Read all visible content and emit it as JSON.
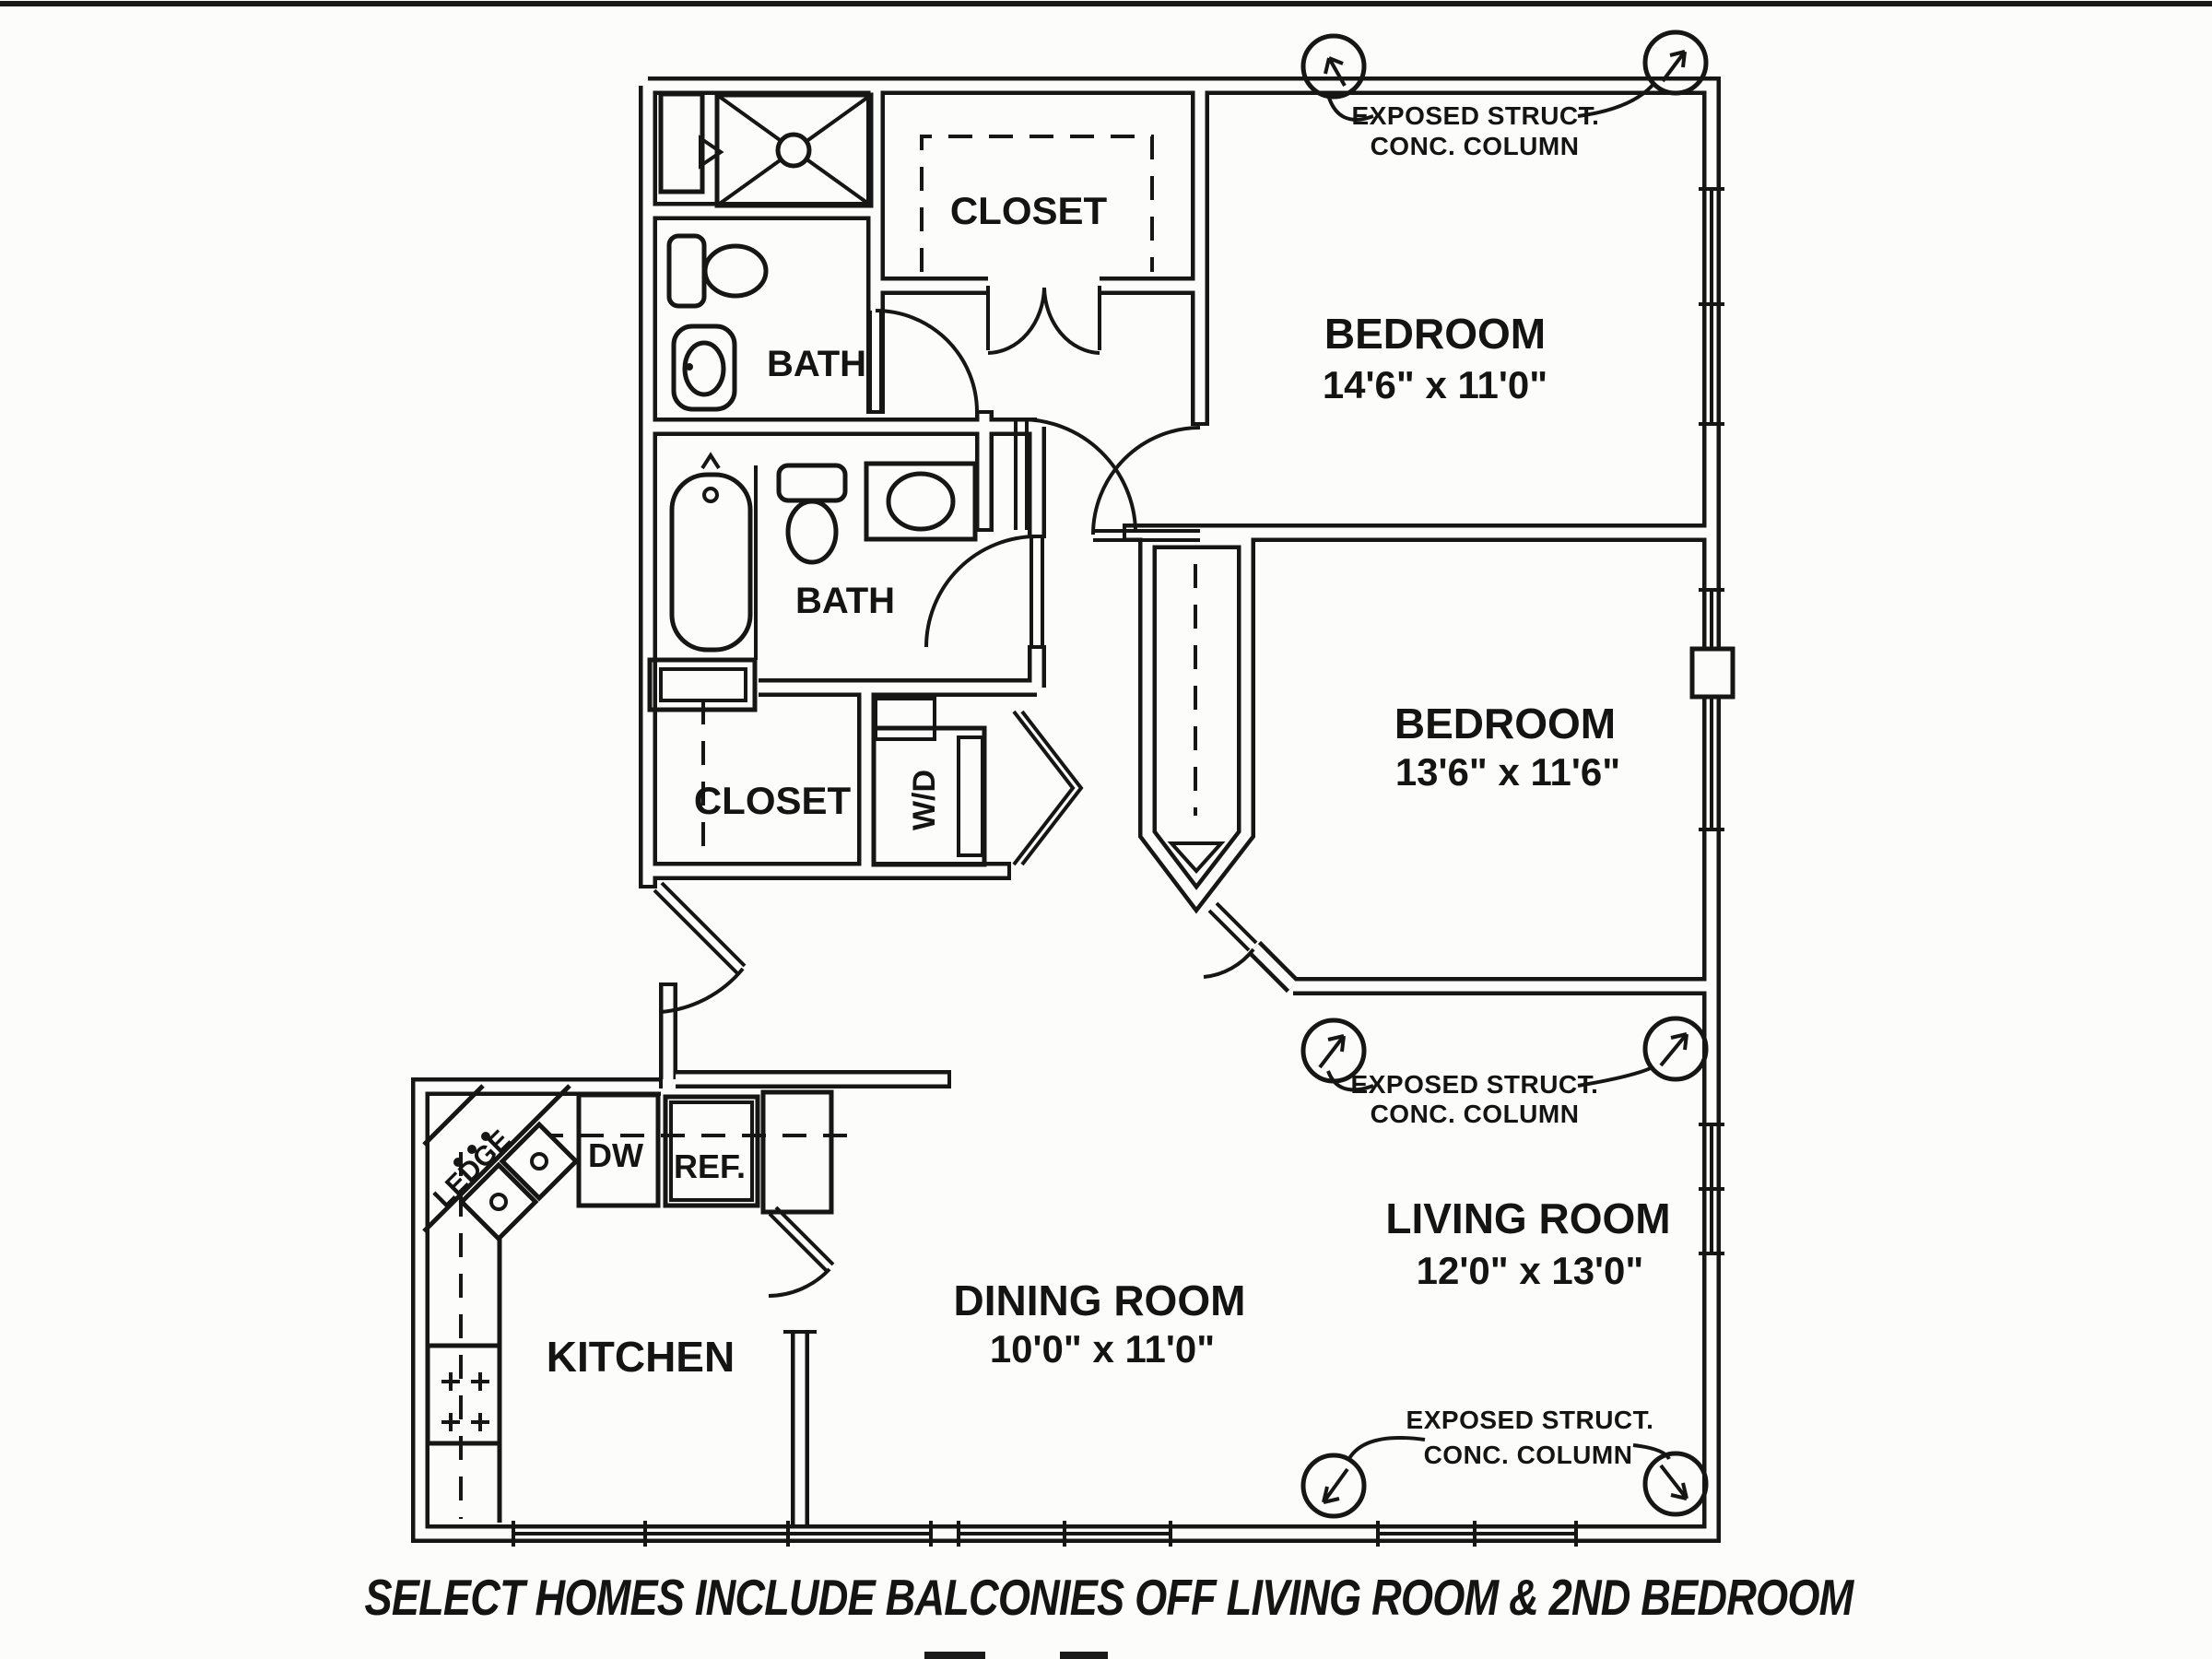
{
  "caption": "SELECT HOMES INCLUDE BALCONIES OFF LIVING ROOM & 2ND BEDROOM",
  "colors": {
    "line": "#161616",
    "background": "#fcfcfa"
  },
  "rooms": {
    "bedroom1": {
      "name": "BEDROOM",
      "dims": "14'6\" x 11'0\""
    },
    "bedroom2": {
      "name": "BEDROOM",
      "dims": "13'6\" x 11'6\""
    },
    "living": {
      "name": "LIVING ROOM",
      "dims": "12'0\" x 13'0\""
    },
    "dining": {
      "name": "DINING ROOM",
      "dims": "10'0\" x 11'0\""
    },
    "kitchen": {
      "name": "KITCHEN"
    },
    "bath_upper": {
      "name": "BATH"
    },
    "bath_lower": {
      "name": "BATH"
    },
    "closet_upper": {
      "name": "CLOSET"
    },
    "closet_lower": {
      "name": "CLOSET"
    }
  },
  "fixtures": {
    "washer_dryer": "W/D",
    "dishwasher": "DW",
    "refrigerator": "REF.",
    "ledge": "LEDGE"
  },
  "annotation": {
    "line1": "EXPOSED STRUCT.",
    "line2": "CONC. COLUMN"
  }
}
